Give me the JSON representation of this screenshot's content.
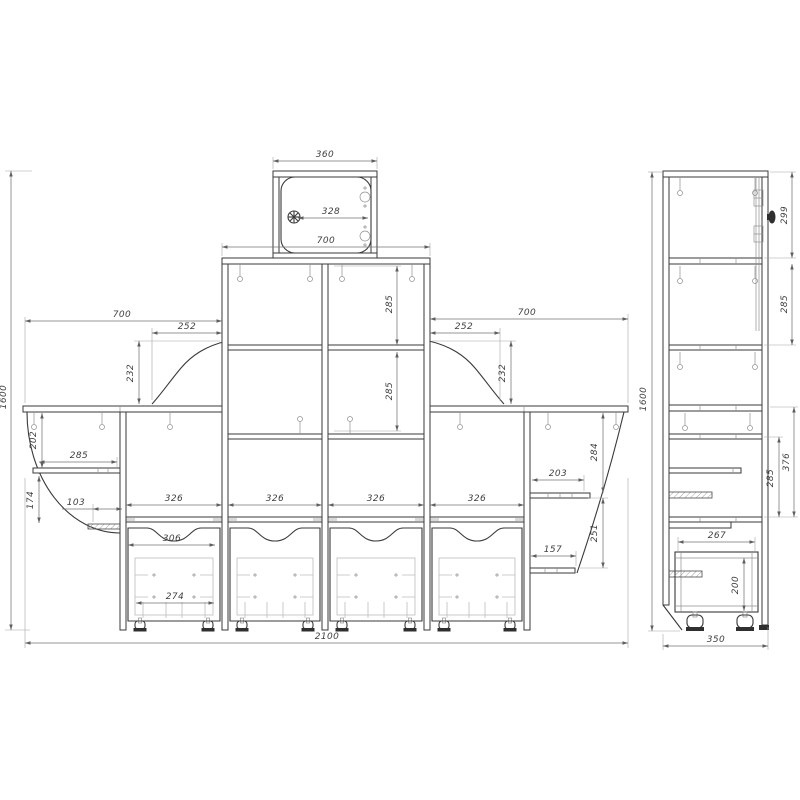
{
  "front_view": {
    "top_cabinet": {
      "width": "360",
      "door_width": "328",
      "base_width": "700"
    },
    "tower": {
      "upper_cell_height": "285",
      "lower_cell_height": "285"
    },
    "left_wing": {
      "width": "700",
      "corbel_width": "252",
      "corbel_height": "232",
      "shelf1_drop": "202",
      "shelf1_width": "285",
      "shelf2_drop": "174",
      "shelf2_width": "103"
    },
    "right_wing": {
      "width": "700",
      "corbel_width": "252",
      "corbel_height": "232",
      "shelf1_width": "203",
      "shelf1_drop": "284",
      "shelf2_drop": "251",
      "shelf2_width": "157"
    },
    "base_bays": {
      "bay1_width": "326",
      "bay2_width": "326",
      "bay3_width": "326",
      "bay4_width": "326",
      "drawer_outer_width": "306",
      "drawer_handle_width": "274"
    },
    "overall": {
      "width": "2100",
      "height": "1600"
    }
  },
  "side_view": {
    "overall_height": "1600",
    "depth": "350",
    "top_section_height": "299",
    "upper_shelf_height": "285",
    "lower_section_height": "376",
    "lower_shelf_height": "285",
    "drawer_depth": "267",
    "drawer_height": "200"
  }
}
